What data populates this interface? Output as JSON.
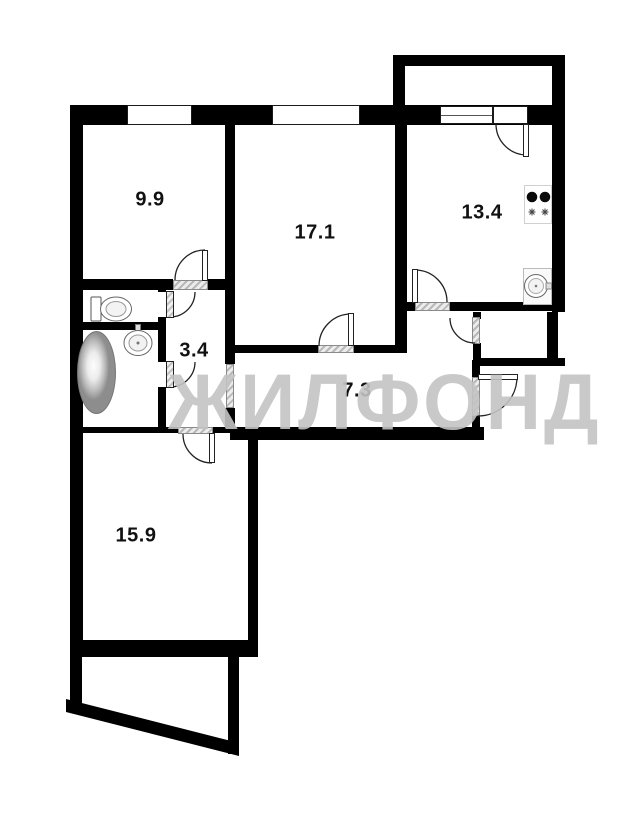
{
  "watermark": {
    "text": "ЖИЛФОНД",
    "color": "#c3c3c3"
  },
  "rooms": [
    {
      "name": "bedroom-top-left",
      "area": "9.9"
    },
    {
      "name": "living-room-center",
      "area": "17.1"
    },
    {
      "name": "kitchen",
      "area": "13.4"
    },
    {
      "name": "bath-corridor",
      "area": "3.4"
    },
    {
      "name": "hallway",
      "area": "7.3"
    },
    {
      "name": "room-bottom-left",
      "area": "15.9"
    }
  ],
  "fixtures": [
    "toilet-icon",
    "bathtub-icon",
    "washbasin-icon",
    "stove-icon",
    "kitchen-sink-icon"
  ],
  "colors": {
    "wall": "#000000",
    "threshold": "#c9c9c9",
    "label": "#111111"
  }
}
